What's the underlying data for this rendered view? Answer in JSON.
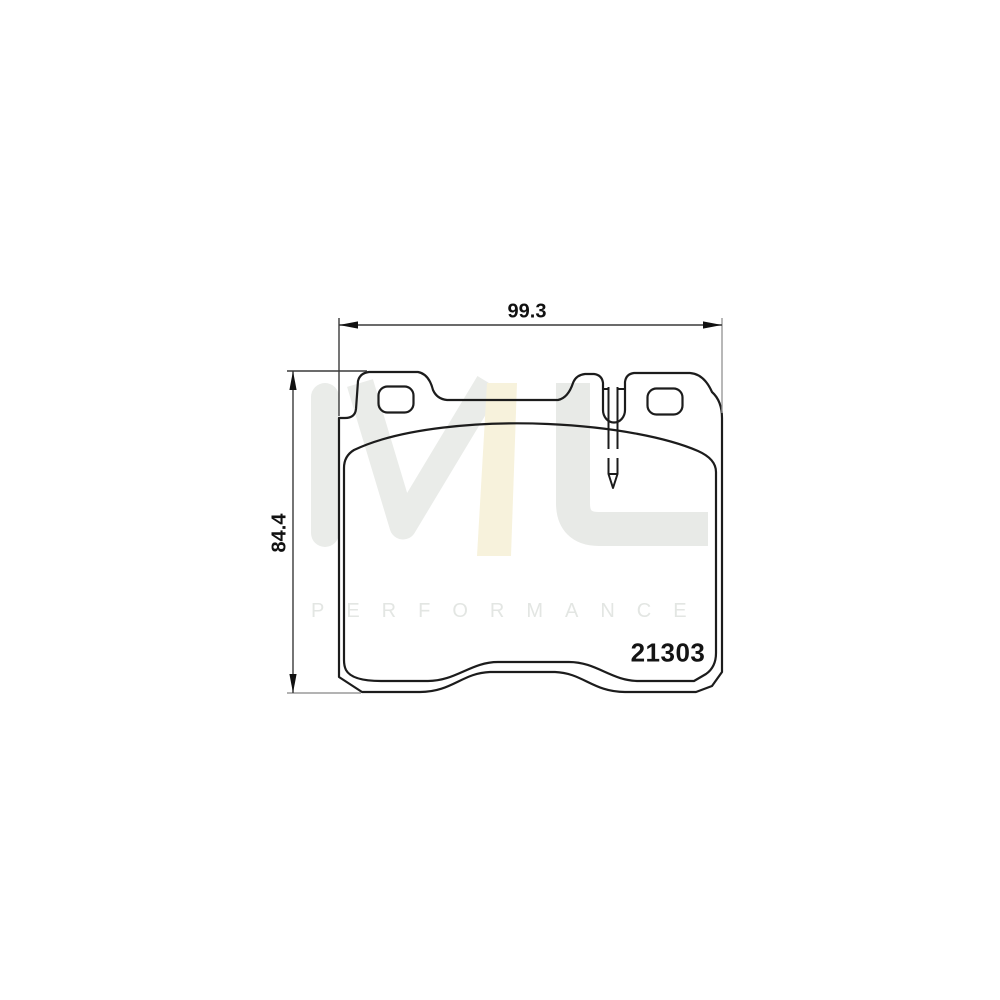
{
  "title": "Brake pad technical drawing",
  "drawing": {
    "part_number": "21303",
    "dimensions": {
      "width_label": "99.3",
      "height_label": "84.4"
    }
  },
  "watermark": {
    "logo_text": "ML",
    "subtext": "PERFORMANCE"
  },
  "colors": {
    "line": "#1c1c1c",
    "dimension_line": "#444444",
    "extension_gray": "#9a9a9a",
    "watermark_gray": "#eaece9",
    "watermark_cream": "#f7f2dc",
    "watermark_text": "#e3e6e3"
  }
}
